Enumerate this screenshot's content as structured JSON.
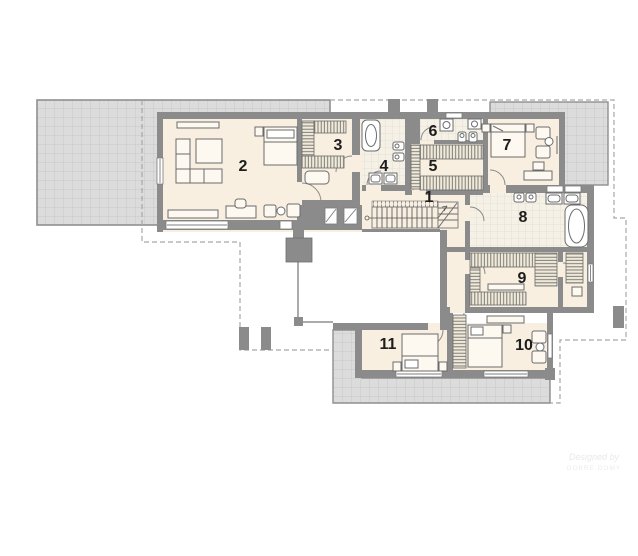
{
  "plan": {
    "type": "floor-plan",
    "floor": "upper"
  },
  "rooms": [
    {
      "number": "1"
    },
    {
      "number": "2"
    },
    {
      "number": "3"
    },
    {
      "number": "4"
    },
    {
      "number": "5"
    },
    {
      "number": "6"
    },
    {
      "number": "7"
    },
    {
      "number": "8"
    },
    {
      "number": "9"
    },
    {
      "number": "10"
    },
    {
      "number": "11"
    }
  ],
  "watermark": {
    "line1": "Designed by",
    "line2": "DOBRE DOMY"
  },
  "colors": {
    "wall": "#8b8b8b",
    "floor": "#f8efe0",
    "terrace": "#dcdcdc",
    "terrace_line": "#c7c7c7",
    "tile": "#f6f1e7",
    "dashed": "#a6a6a6",
    "label": "#1d1d1d"
  }
}
